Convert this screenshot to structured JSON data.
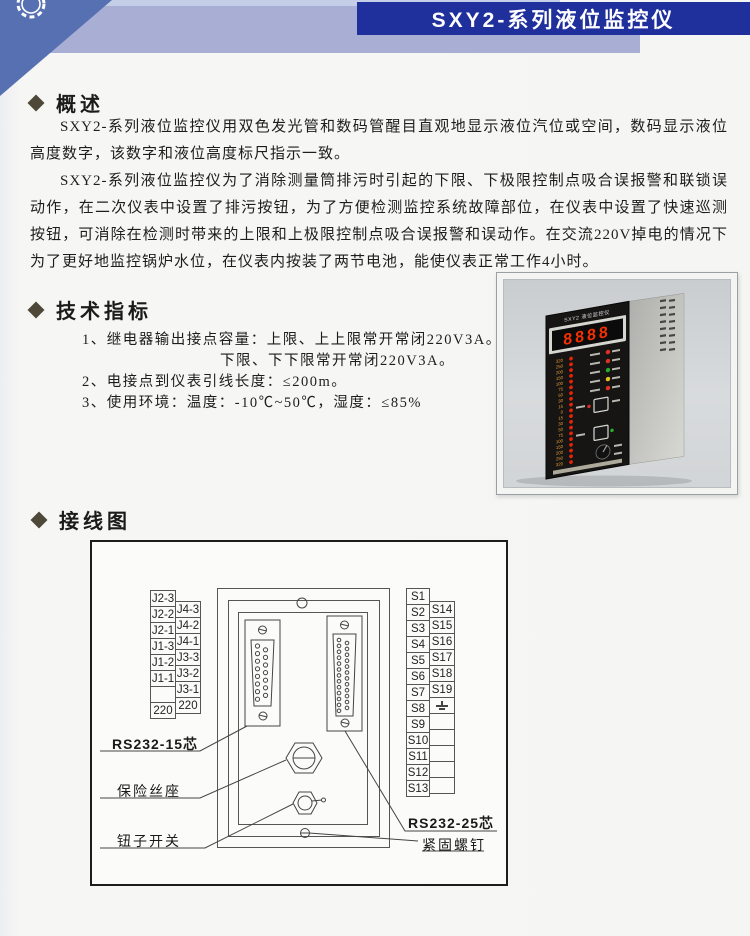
{
  "colors": {
    "accent-blue": "#1f2f9b",
    "band": "#a9aed4",
    "band-light": "#c4cee6",
    "triangle": "#5670b2",
    "diamond": "#4e4838"
  },
  "banner": {
    "title": "SXY2-系列液位监控仪"
  },
  "overview": {
    "heading": "概述",
    "p1": "SXY2-系列液位监控仪用双色发光管和数码管醒目直观地显示液位汽位或空间，数码显示液位高度数字，该数字和液位高度标尺指示一致。",
    "p2": "SXY2-系列液位监控仪为了消除测量筒排污时引起的下限、下极限控制点吸合误报警和联锁误动作，在二次仪表中设置了排污按钮，为了方便检测监控系统故障部位，在仪表中设置了快速巡测按钮，可消除在检测时带来的上限和上极限控制点吸合误报警和误动作。在交流220V掉电的情况下为了更好地监控锅炉水位，在仪表内按装了两节电池，能使仪表正常工作4小时。"
  },
  "specs": {
    "heading": "技术指标",
    "item1": "1、继电器输出接点容量：上限、上上限常开常闭220V3A。",
    "item1_sub": "下限、下下限常开常闭220V3A。",
    "item2": "2、电接点到仪表引线长度：≤200m。",
    "item3": "3、使用环境：温度：-10℃~50℃，湿度：≤85%"
  },
  "photo": {
    "panel_title": "SXY2 液位监控仪",
    "display": "8888",
    "scale_values": [
      "320",
      "250",
      "200",
      "150",
      "100",
      "75",
      "50",
      "30",
      "15",
      "0",
      "15",
      "30",
      "50",
      "75",
      "100",
      "150",
      "200",
      "250",
      "320"
    ]
  },
  "wiring": {
    "heading": "接线图",
    "left_col1": [
      "J2-3",
      "J2-2",
      "J2-1",
      "J1-3",
      "J1-2",
      "J1-1",
      "",
      "220"
    ],
    "left_col2": [
      "J4-3",
      "J4-2",
      "J4-1",
      "J3-3",
      "J3-2",
      "J3-1",
      "220"
    ],
    "right_col1": [
      "S1",
      "S2",
      "S3",
      "S4",
      "S5",
      "S6",
      "S7",
      "S8",
      "S9",
      "S10",
      "S11",
      "S12",
      "S13"
    ],
    "right_col2": [
      "S14",
      "S15",
      "S16",
      "S17",
      "S18",
      "S19",
      "GND",
      "",
      "",
      "",
      "",
      ""
    ],
    "label_db15": "RS232-15芯",
    "label_fuse": "保险丝座",
    "label_toggle": "钮子开关",
    "label_db25": "RS232-25芯",
    "label_screw": "紧固螺钉"
  }
}
